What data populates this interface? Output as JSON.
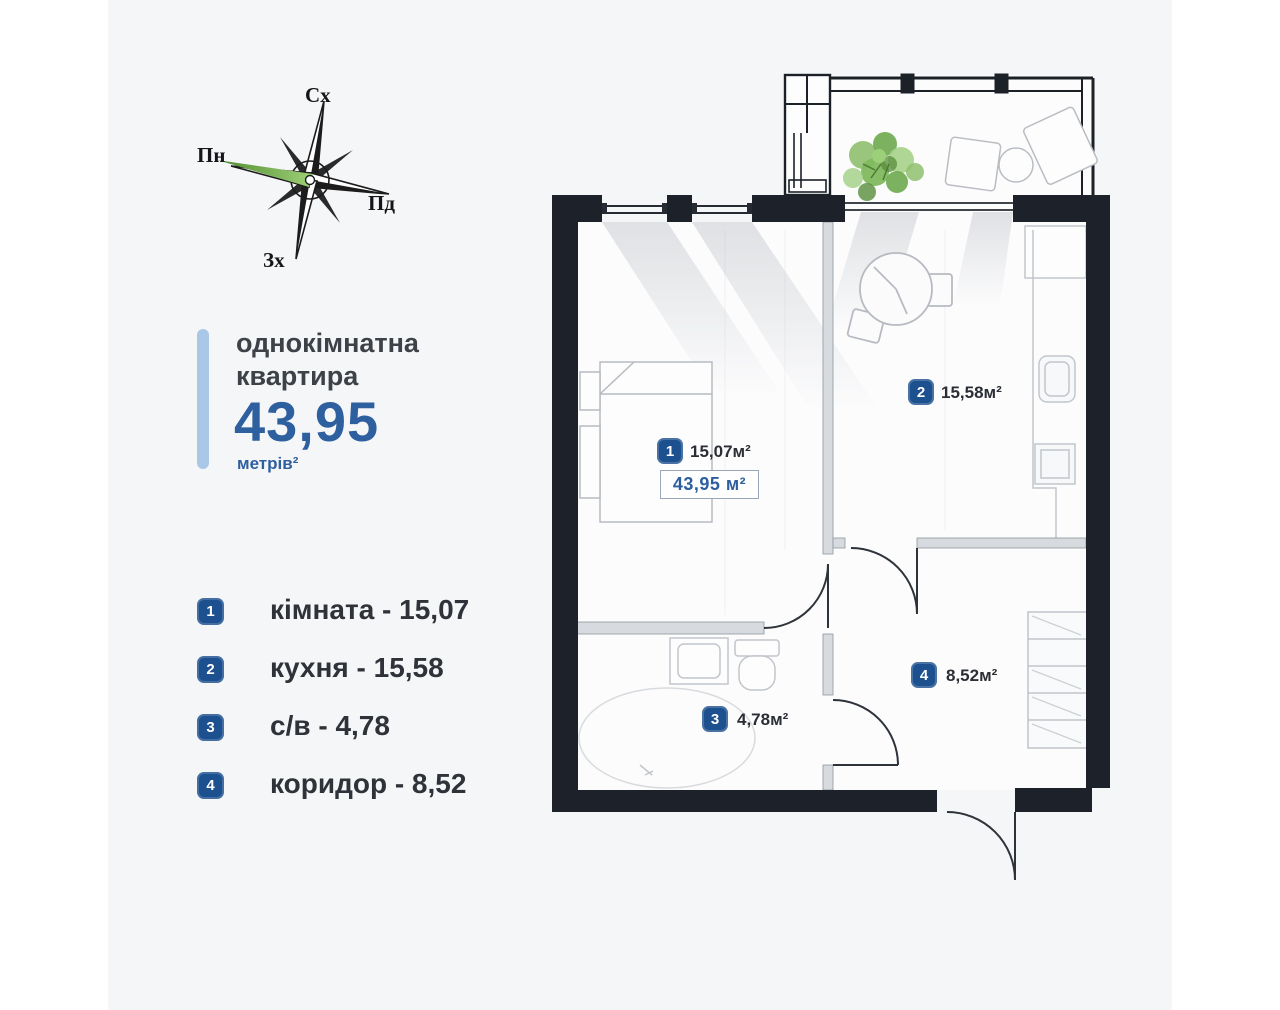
{
  "compass": {
    "east": "Сх",
    "north": "Пн",
    "south": "Пд",
    "west": "Зх"
  },
  "title": {
    "line1": "однокімнатна",
    "line2": "квартира",
    "value": "43,95",
    "unit": "метрів²"
  },
  "legend": {
    "items": [
      {
        "num": "1",
        "label": "кімната - 15,07"
      },
      {
        "num": "2",
        "label": "кухня - 15,58"
      },
      {
        "num": "3",
        "label": "с/в - 4,78"
      },
      {
        "num": "4",
        "label": "коридор - 8,52"
      }
    ]
  },
  "plan": {
    "total_area_label": "43,95 м²",
    "rooms": [
      {
        "num": "1",
        "area_label": "15,07м²"
      },
      {
        "num": "2",
        "area_label": "15,58м²"
      },
      {
        "num": "3",
        "area_label": "4,78м²"
      },
      {
        "num": "4",
        "area_label": "8,52м²"
      }
    ]
  },
  "colors": {
    "accent_blue": "#2e5f9e",
    "badge_blue": "#1d508f",
    "accent_bar": "#a9c7e6",
    "wall_dark": "#1d222a",
    "plant_green": "#79b35a"
  }
}
